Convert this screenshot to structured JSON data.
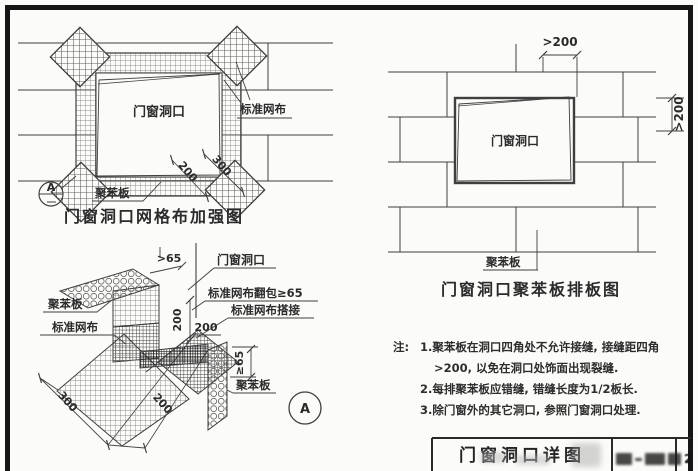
{
  "colors": {
    "paper": "#fbfbf9",
    "ink": "#3f3f3f",
    "frame": "#161616"
  },
  "reinforcement_diagram": {
    "title": "门窗洞口网格布加强图",
    "opening_label": "门窗洞口",
    "mesh_label": "标准网布",
    "board_label": "聚苯板",
    "dim_200": "200",
    "dim_300": "300",
    "marker_letter": "A"
  },
  "layout_diagram": {
    "title": "门窗洞口聚苯板排板图",
    "opening_label": "门窗洞口",
    "board_label": "聚苯板",
    "dim_top": ">200",
    "dim_right": ">200"
  },
  "corner_detail": {
    "opening_label": "门窗洞口",
    "wrap_label": "标准网布翻包≥65",
    "lap_label": "标准网布搭接",
    "mesh_label": "标准网布",
    "board_label_left": "聚苯板",
    "board_label_right": "聚苯板",
    "dim_top": ">65",
    "dim_v200": "200",
    "dim_h200": "200",
    "dim_right65": "≥65",
    "dim_300": "300",
    "dim_200": "200",
    "marker_letter": "A"
  },
  "notes": {
    "label": "注:",
    "lines": [
      "1.聚苯板在洞口四角处不允许接缝, 接缝距四角",
      ">200, 以免在洞口处饰面出现裂缝.",
      "2.每排聚苯板应错缝, 错缝长度为1/2板长.",
      "3.除门窗外的其它洞口, 参照门窗洞口处理."
    ]
  },
  "title_block": {
    "drawing_title": "门窗洞口详图",
    "number_suffix": "2"
  }
}
